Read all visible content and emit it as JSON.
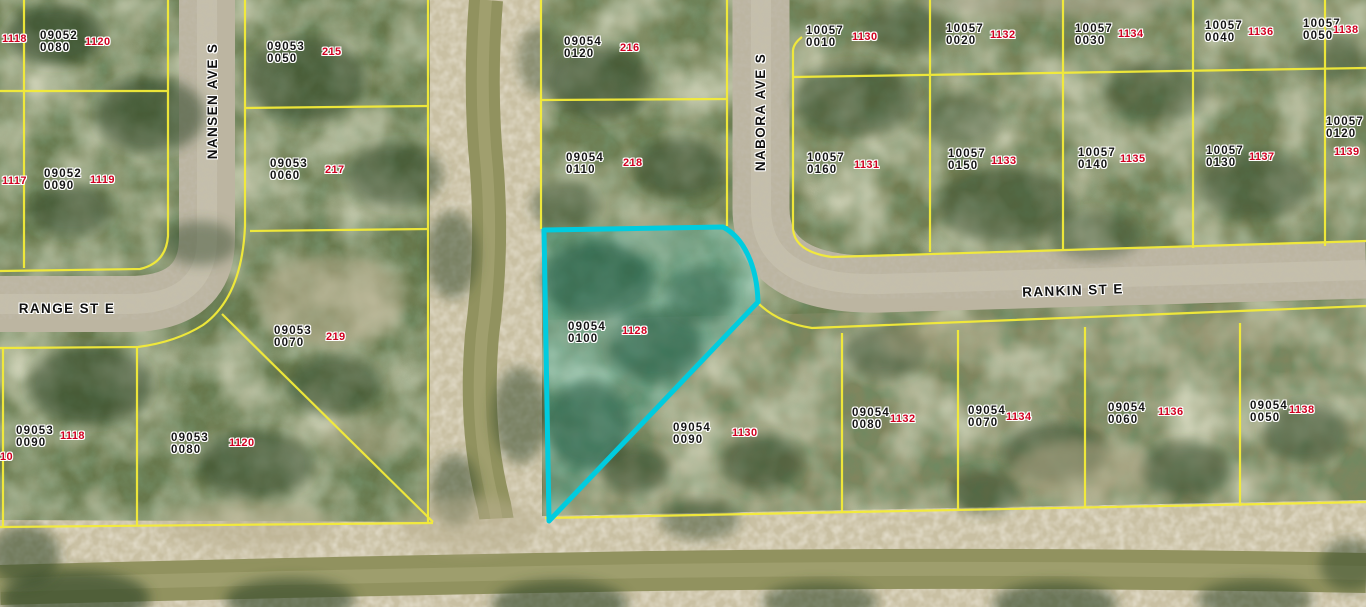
{
  "map": {
    "type": "aerial-parcel-map",
    "canvas": {
      "width": 1366,
      "height": 607
    },
    "highlighted_parcel": {
      "parcel_id": "09054 0100",
      "lot_number": "1128",
      "outline_color": "#00ccdf"
    },
    "colors": {
      "parcel_line": "#f4ec38",
      "highlight_outline": "#00ccdf",
      "lot_number_text": "#d00020",
      "parcel_id_text": "#141414",
      "label_halo": "#ffffff",
      "road_surface": "#bcb5a1",
      "canal_bank": "#c9c0a3",
      "canal_water": "#91925f",
      "vegetation_base": "#6e7c50"
    },
    "streets": [
      {
        "name": "NANSEN AVE S",
        "cx": 213,
        "cy": 101,
        "rotation": -90
      },
      {
        "name": "NABORA AVE S",
        "cx": 761,
        "cy": 112,
        "rotation": -90
      },
      {
        "name": "RANGE ST E",
        "cx": 67,
        "cy": 309,
        "rotation": 0
      },
      {
        "name": "RANKIN ST E",
        "cx": 1073,
        "cy": 291,
        "rotation": -2
      }
    ],
    "parcels": [
      {
        "block": "09052",
        "unit": "0080",
        "lot": "1120",
        "x": 40,
        "y": 30,
        "lx": 85,
        "ly": 37
      },
      {
        "block": "09052",
        "unit": "0090",
        "lot": "1119",
        "x": 44,
        "y": 168,
        "lx": 90,
        "ly": 175
      },
      {
        "block": "09053",
        "unit": "0050",
        "lot": "215",
        "x": 267,
        "y": 41,
        "lx": 322,
        "ly": 47
      },
      {
        "block": "09053",
        "unit": "0060",
        "lot": "217",
        "x": 270,
        "y": 158,
        "lx": 325,
        "ly": 165
      },
      {
        "block": "09053",
        "unit": "0070",
        "lot": "219",
        "x": 274,
        "y": 325,
        "lx": 326,
        "ly": 332
      },
      {
        "block": "09053",
        "unit": "0090",
        "lot": "1118",
        "x": 16,
        "y": 425,
        "lx": 60,
        "ly": 431
      },
      {
        "block": "09053",
        "unit": "0080",
        "lot": "1120",
        "x": 171,
        "y": 432,
        "lx": 229,
        "ly": 438
      },
      {
        "block": "09054",
        "unit": "0120",
        "lot": "216",
        "x": 564,
        "y": 36,
        "lx": 620,
        "ly": 43
      },
      {
        "block": "09054",
        "unit": "0110",
        "lot": "218",
        "x": 566,
        "y": 152,
        "lx": 623,
        "ly": 158
      },
      {
        "block": "09054",
        "unit": "0100",
        "lot": "1128",
        "x": 568,
        "y": 321,
        "lx": 622,
        "ly": 326,
        "highlighted": true
      },
      {
        "block": "09054",
        "unit": "0090",
        "lot": "1130",
        "x": 673,
        "y": 422,
        "lx": 732,
        "ly": 428
      },
      {
        "block": "09054",
        "unit": "0080",
        "lot": "1132",
        "x": 852,
        "y": 407,
        "lx": 890,
        "ly": 414
      },
      {
        "block": "09054",
        "unit": "0070",
        "lot": "1134",
        "x": 968,
        "y": 405,
        "lx": 1006,
        "ly": 412
      },
      {
        "block": "09054",
        "unit": "0060",
        "lot": "1136",
        "x": 1108,
        "y": 402,
        "lx": 1158,
        "ly": 407
      },
      {
        "block": "09054",
        "unit": "0050",
        "lot": "1138",
        "x": 1250,
        "y": 400,
        "lx": 1289,
        "ly": 405
      },
      {
        "block": "10057",
        "unit": "0010",
        "lot": "1130",
        "x": 806,
        "y": 25,
        "lx": 852,
        "ly": 32
      },
      {
        "block": "10057",
        "unit": "0020",
        "lot": "1132",
        "x": 946,
        "y": 23,
        "lx": 990,
        "ly": 30
      },
      {
        "block": "10057",
        "unit": "0030",
        "lot": "1134",
        "x": 1075,
        "y": 23,
        "lx": 1118,
        "ly": 29
      },
      {
        "block": "10057",
        "unit": "0040",
        "lot": "1136",
        "x": 1205,
        "y": 20,
        "lx": 1248,
        "ly": 27
      },
      {
        "block": "10057",
        "unit": "0050",
        "lot": "1138",
        "x": 1303,
        "y": 18,
        "lx": 1333,
        "ly": 25
      },
      {
        "block": "10057",
        "unit": "0160",
        "lot": "1131",
        "x": 807,
        "y": 152,
        "lx": 854,
        "ly": 160
      },
      {
        "block": "10057",
        "unit": "0150",
        "lot": "1133",
        "x": 948,
        "y": 148,
        "lx": 991,
        "ly": 156
      },
      {
        "block": "10057",
        "unit": "0140",
        "lot": "1135",
        "x": 1078,
        "y": 147,
        "lx": 1120,
        "ly": 154
      },
      {
        "block": "10057",
        "unit": "0130",
        "lot": "1137",
        "x": 1206,
        "y": 145,
        "lx": 1249,
        "ly": 152
      },
      {
        "block": "10057",
        "unit": "0120",
        "lot": "1139",
        "x": 1326,
        "y": 116,
        "lx": 1334,
        "ly": 147
      }
    ],
    "edge_lot_numbers": [
      {
        "text": "1118",
        "x": 2,
        "y": 34
      },
      {
        "text": "1117",
        "x": 2,
        "y": 176
      },
      {
        "text": "10",
        "x": 0,
        "y": 452
      }
    ]
  }
}
